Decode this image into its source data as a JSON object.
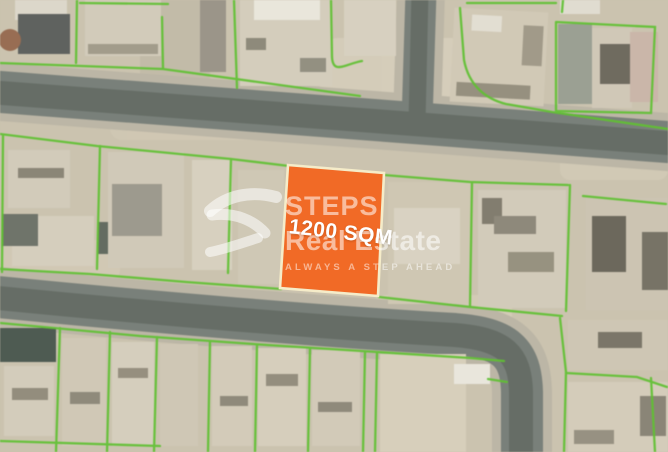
{
  "listing_image": {
    "plot": {
      "area_label": "1200 SQM",
      "fill_color": "#f16a26",
      "border_color": "#f5ecc9",
      "label_color": "#ffffff"
    },
    "watermark": {
      "brand_top": "STEPS",
      "brand_bottom": "Real Estate",
      "tagline": "ALWAYS A STEP AHEAD",
      "logo": "steps-swoosh-icon",
      "color": "#ffffff"
    },
    "map": {
      "boundary_color": "#5ec22f",
      "road_color": "#79807a",
      "road_center_color": "#666d66",
      "sidewalk_color": "#bcb6a5",
      "ground_color": "#cbc3ae"
    }
  }
}
